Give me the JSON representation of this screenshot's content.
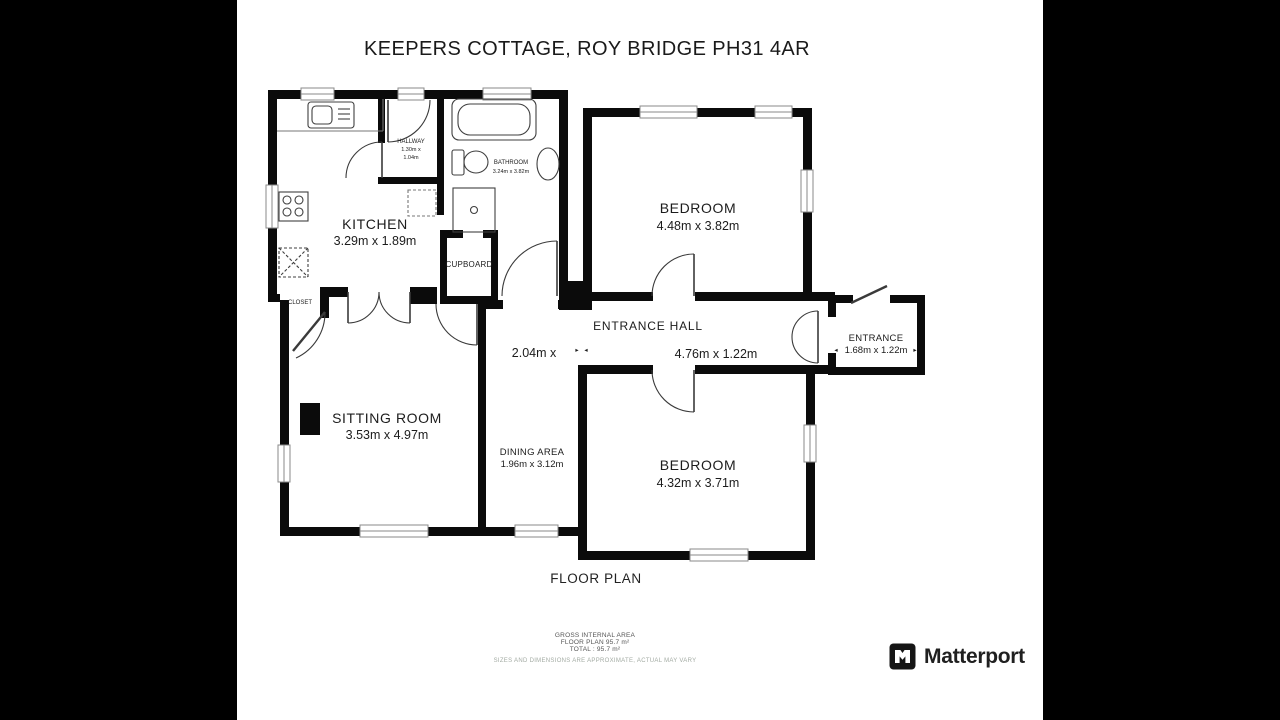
{
  "title": "KEEPERS COTTAGE, ROY BRIDGE PH31 4AR",
  "plan": {
    "caption": "FLOOR PLAN",
    "rooms": {
      "kitchen": {
        "name": "KITCHEN",
        "dims": "3.29m x 1.89m"
      },
      "hallway": {
        "name": "HALLWAY",
        "dims_l1": "1.30m x",
        "dims_l2": "1.04m"
      },
      "bathroom": {
        "name": "BATHROOM",
        "dims": "3.24m x 3.82m"
      },
      "cupboard": {
        "name": "CUPBOARD"
      },
      "closet": {
        "name": "CLOSET"
      },
      "bedroom_top": {
        "name": "BEDROOM",
        "dims": "4.48m x 3.82m"
      },
      "entrance_hall": {
        "name": "ENTRANCE HALL",
        "dims": "4.76m x 1.22m",
        "partial_dims": "2.04m x"
      },
      "entrance": {
        "name": "ENTRANCE",
        "dims": "1.68m x 1.22m"
      },
      "sitting_room": {
        "name": "SITTING ROOM",
        "dims": "3.53m x 4.97m"
      },
      "dining_area": {
        "name": "DINING AREA",
        "dims": "1.96m x 3.12m"
      },
      "bedroom_bottom": {
        "name": "BEDROOM",
        "dims": "4.32m x 3.71m"
      }
    },
    "arrows": {
      "left": "◂",
      "right": "▸"
    }
  },
  "footer": {
    "area_title": "GROSS INTERNAL AREA",
    "area_floor": "FLOOR PLAN 95.7 m²",
    "area_total": "TOTAL : 95.7 m²",
    "disclaimer": "SIZES AND DIMENSIONS ARE APPROXIMATE, ACTUAL MAY VARY"
  },
  "branding": {
    "name": "Matterport"
  },
  "colors": {
    "wall": "#0b0b0b",
    "background": "#ffffff",
    "bars": "#000000"
  }
}
